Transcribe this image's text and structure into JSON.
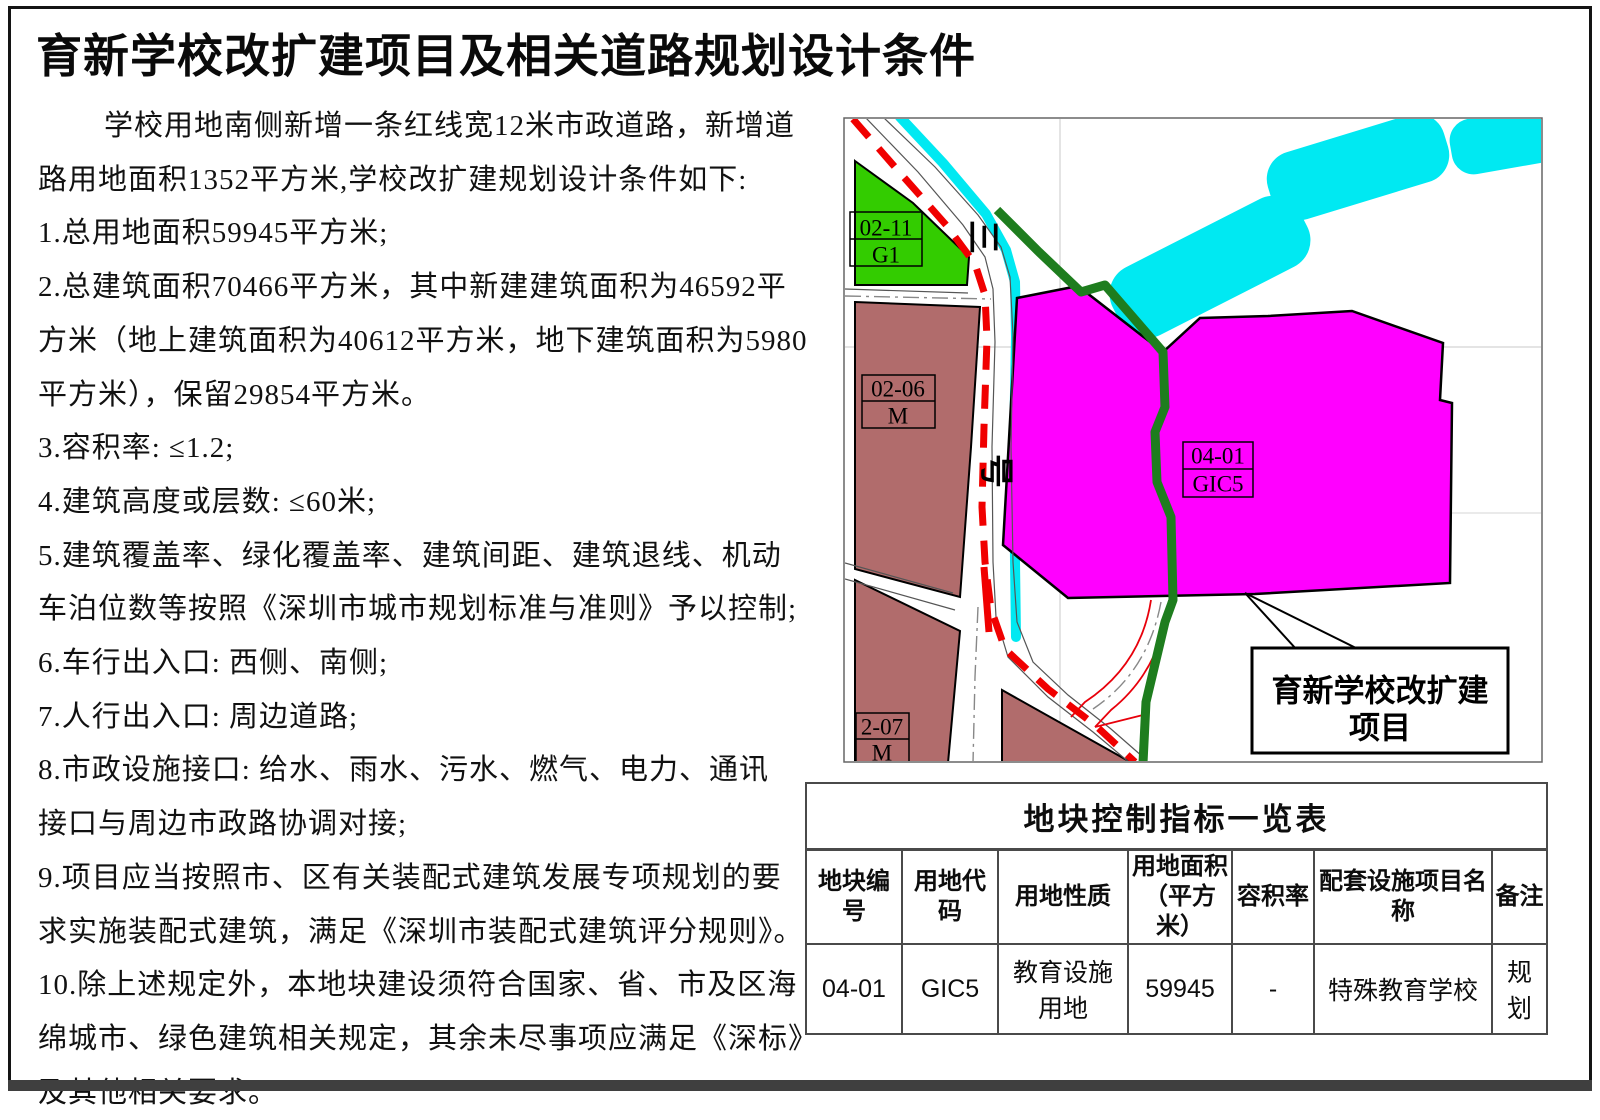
{
  "title": "育新学校改扩建项目及相关道路规划设计条件",
  "body_lines": [
    "学校用地南侧新增一条红线宽12米市政道路，新增道",
    "路用地面积1352平方米,学校改扩建规划设计条件如下:",
    "1.总用地面积59945平方米;",
    "2.总建筑面积70466平方米，其中新建建筑面积为46592平",
    "方米（地上建筑面积为40612平方米，地下建筑面积为5980",
    "平方米），保留29854平方米。",
    "3.容积率: ≤1.2;",
    "4.建筑高度或层数: ≤60米;",
    "5.建筑覆盖率、绿化覆盖率、建筑间距、建筑退线、机动",
    "车泊位数等按照《深圳市城市规划标准与准则》予以控制;",
    "6.车行出入口: 西侧、南侧;",
    "7.人行出入口: 周边道路;",
    "8.市政设施接口: 给水、雨水、污水、燃气、电力、通讯",
    "接口与周边市政路协调对接;",
    "9.项目应当按照市、区有关装配式建筑发展专项规划的要",
    "求实施装配式建筑，满足《深圳市装配式建筑评分规则》。",
    "10.除上述规定外，本地块建设须符合国家、省、市及区海",
    "绵城市、绿色建筑相关规定，其余未尽事项应满足《深标》",
    "及其他相关要求。"
  ],
  "map": {
    "road_name_char_top": "三",
    "road_name_char_bottom": "号",
    "zone_labels": {
      "z0211": {
        "line1": "02-11",
        "line2": "G1"
      },
      "z0206": {
        "line1": "02-06",
        "line2": "M"
      },
      "z0401": {
        "line1": "04-01",
        "line2": "GIC5"
      },
      "z0207": {
        "line1": "2-07",
        "line2": "M"
      }
    },
    "callout": {
      "line1": "育新学校改扩建",
      "line2": "项目"
    },
    "colors": {
      "green_space": "#33cc00",
      "industrial_brown": "#b16c6c",
      "project_magenta": "#ff00ff",
      "water_cyan": "#00e9f2",
      "boundary_green": "#1e7d1e",
      "road_centerline_red": "#f00000"
    }
  },
  "table": {
    "title": "地块控制指标一览表",
    "headers": [
      "地块编号",
      "用地代码",
      "用地性质",
      "用地面积\n（平方米）",
      "容积率",
      "配套设施项目名称",
      "备注"
    ],
    "rows": [
      [
        "04-01",
        "GIC5",
        "教育设施用地",
        "59945",
        "-",
        "特殊教育学校",
        "规划"
      ]
    ]
  }
}
